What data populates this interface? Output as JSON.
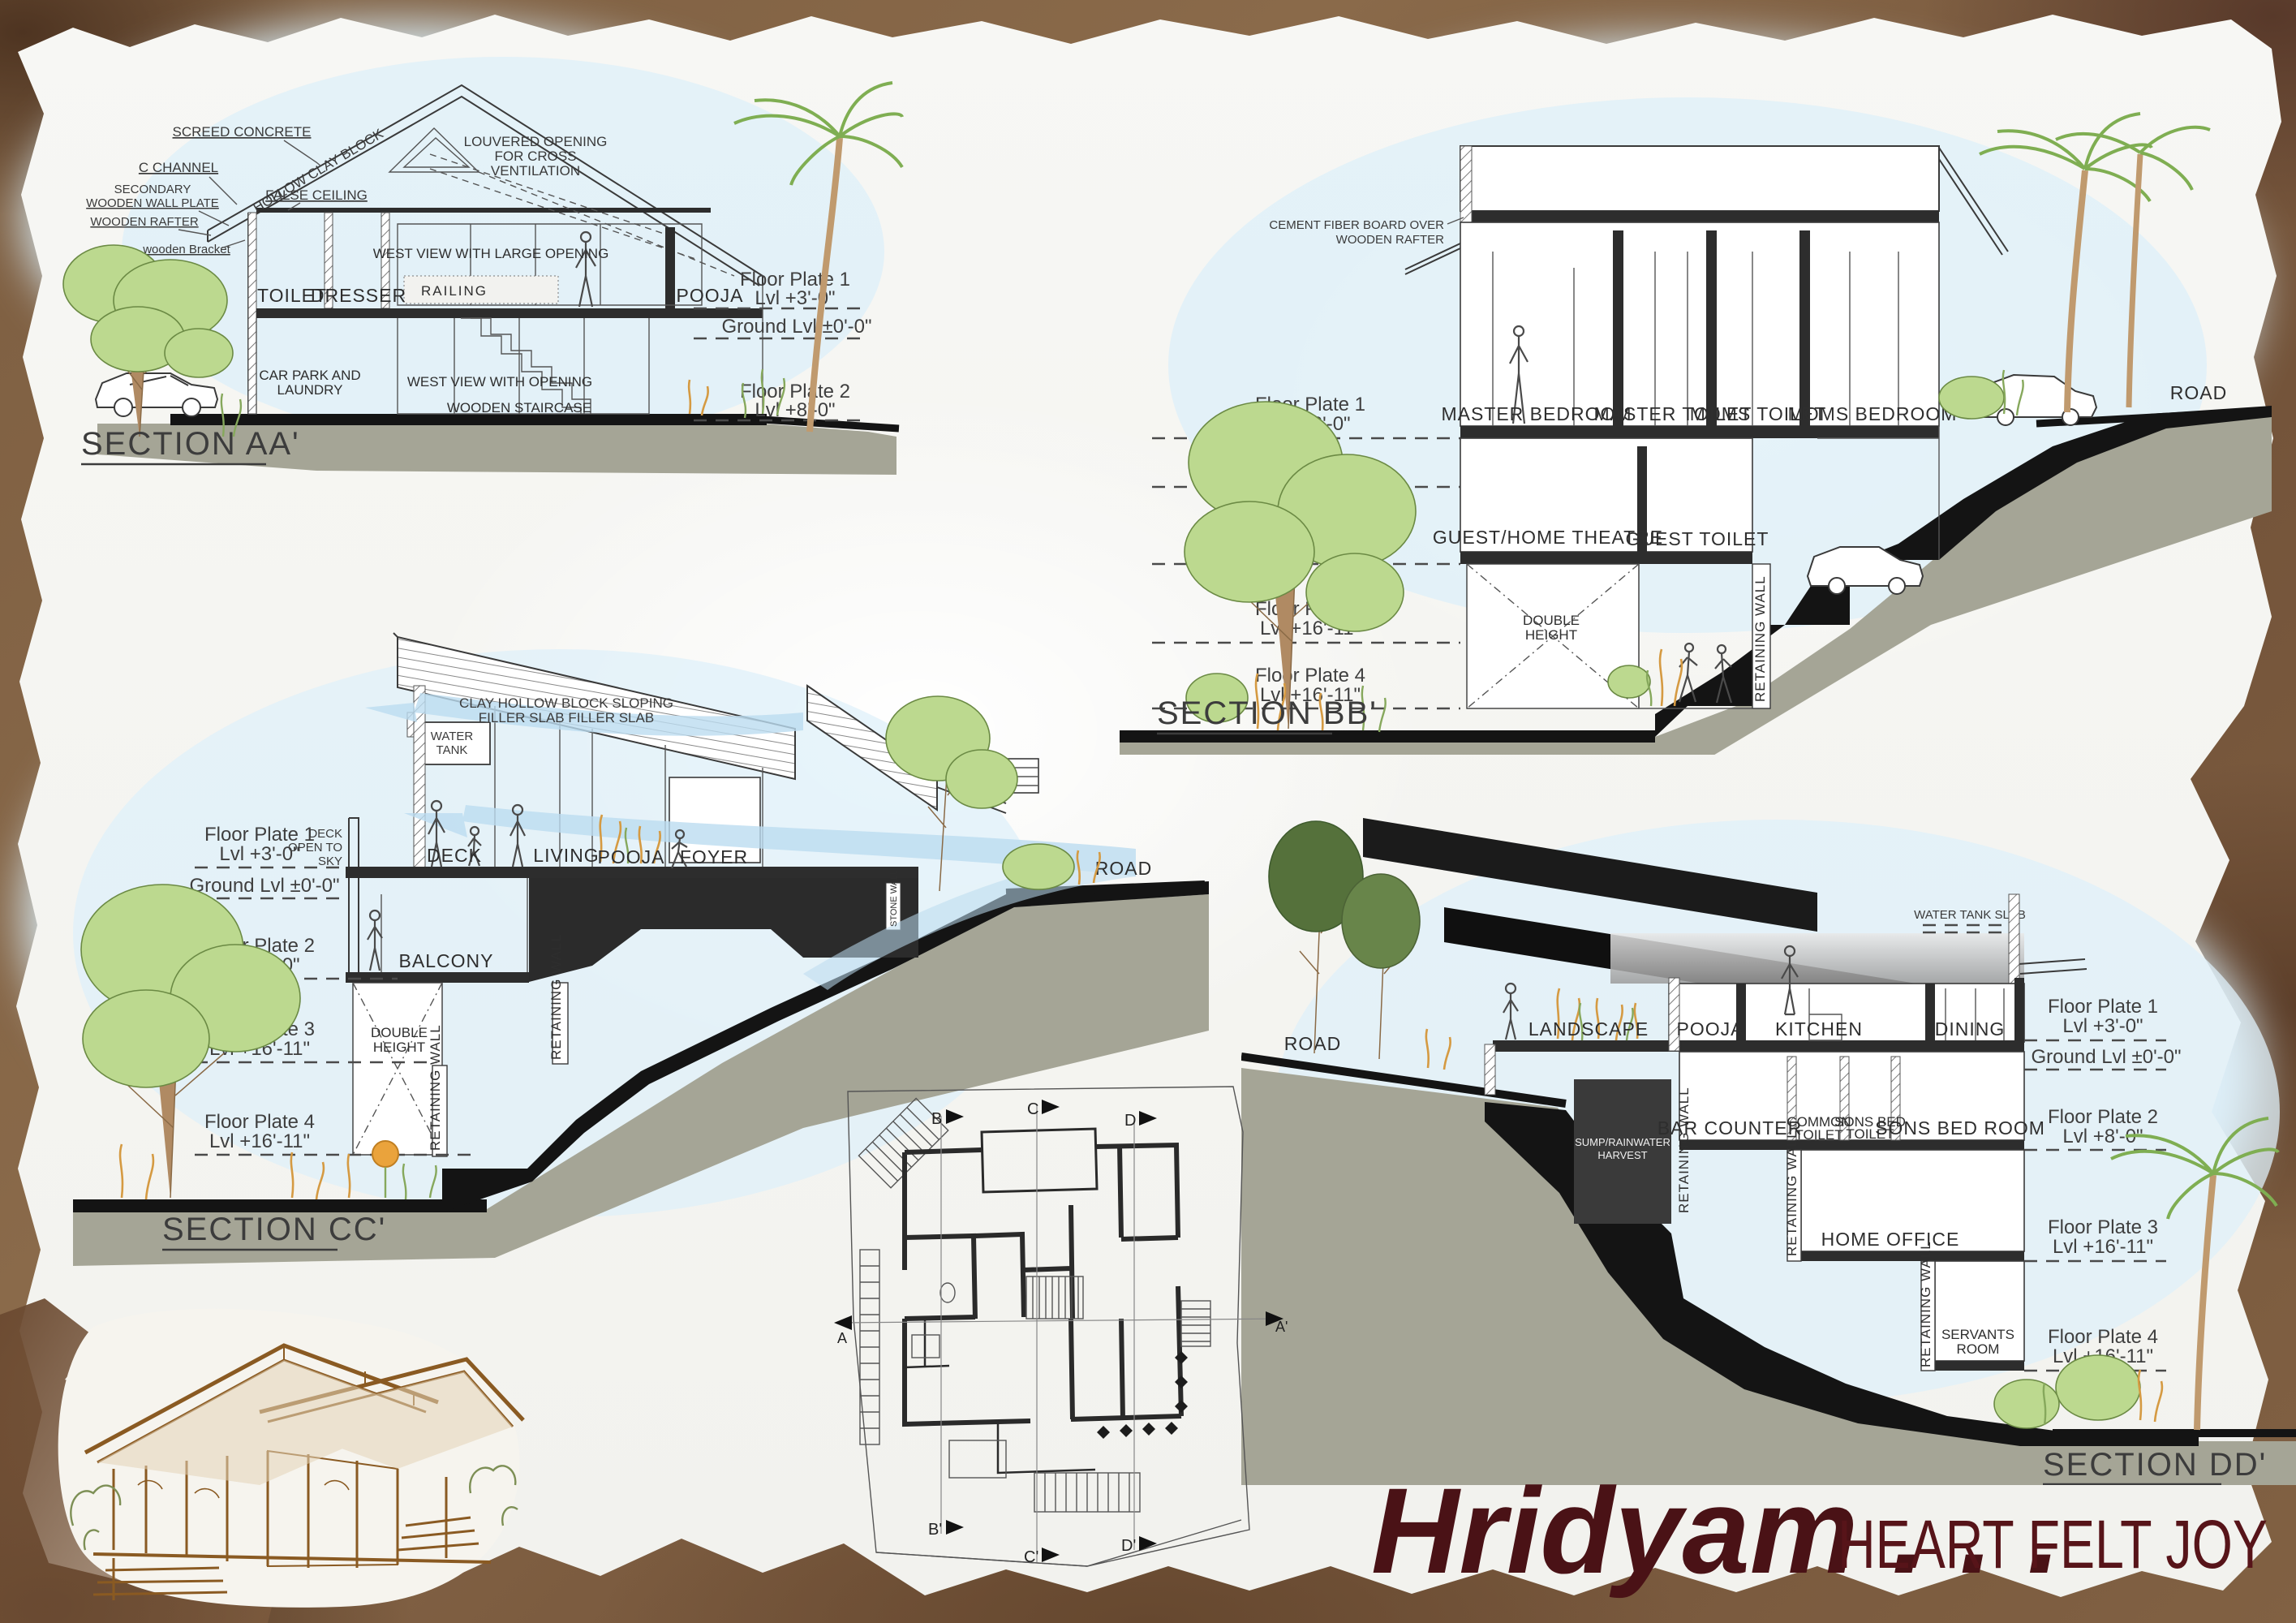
{
  "title": {
    "script": "Hridyam . . .",
    "caps": "HEART FELT JOY"
  },
  "levels": {
    "fp1a": "Floor Plate 1",
    "fp1b": "Lvl +3'-0\"",
    "ground": "Ground Lvl ±0'-0\"",
    "fp2a": "Floor Plate 2",
    "fp2b": "Lvl +8'-0\"",
    "fp3a": "Floor Plate 3",
    "fp3b": "Lvl +16'-11\"",
    "fp4a": "Floor Plate 4",
    "fp4b": "Lvl +16'-11\""
  },
  "shared": {
    "road": "ROAD",
    "retaining_wall": "RETAINING WALL",
    "double_1": "DOUBLE",
    "double_2": "HEIGHT"
  },
  "sections": {
    "aa": {
      "label": "SECTION AA'",
      "screed": "SCREED CONCRETE",
      "c_channel": "C CHANNEL",
      "sec_plate_1": "SECONDARY",
      "sec_plate_2": "WOODEN WALL PLATE",
      "rafter": "WOODEN RAFTER",
      "bracket": "wooden Bracket",
      "hollow": "HOLLOW CLAY BLOCK",
      "false_ceiling": "FALSE CEILING",
      "louver_1": "LOUVERED OPENING",
      "louver_2": "FOR CROSS",
      "louver_3": "VENTILATION",
      "west_large": "WEST VIEW WITH LARGE OPENING",
      "west_open": "WEST VIEW WITH  OPENING",
      "staircase": "WOODEN STAIRCASE",
      "railing": "RAILING",
      "toilet": "TOILET",
      "dresser": "DRESSER",
      "pooja": "POOJA",
      "carpark_1": "CAR PARK AND",
      "carpark_2": "LAUNDRY"
    },
    "bb": {
      "label": "SECTION BB'",
      "fiber_1": "CEMENT FIBER BOARD OVER",
      "fiber_2": "WOODEN RAFTER",
      "master_bedroom": "MASTER BEDROOM",
      "master_toilet": "MASTER TOILET",
      "moms_toilet": "MOMS TOILET",
      "moms_bedroom": "MOMS BEDROOM",
      "guest": "GUEST/HOME THEATRE",
      "guest_toilet": "GUEST TOILET"
    },
    "cc": {
      "label": "SECTION CC'",
      "clay_1": "CLAY HOLLOW BLOCK SLOPING",
      "clay_2": "FILLER SLAB FILLER SLAB",
      "water_1": "WATER",
      "water_2": "TANK",
      "deck_open_1": "DECK",
      "deck_open_2": "OPEN TO",
      "deck_open_3": "SKY",
      "deck": "DECK",
      "living": "LIVING",
      "pooja": "POOJA",
      "foyer": "FOYER",
      "balcony": "BALCONY",
      "stone_wall": "STONE WALL"
    },
    "dd": {
      "label": "SECTION DD'",
      "water_tank_slab": "WATER TANK SLAB",
      "landscape": "LANDSCAPE",
      "pooja": "POOJA",
      "kitchen": "KITCHEN",
      "dining": "DINING",
      "sump_1": "SUMP/RAINWATER",
      "sump_2": "HARVEST",
      "bar": "BAR COUNTER",
      "common_1": "COMMON",
      "common_2": "TOILET",
      "sons_toilet_1": "SONS BED",
      "sons_toilet_2": "TOILET",
      "sons_bedroom": "SONS BED ROOM",
      "home_office": "HOME OFFICE",
      "servants_1": "SERVANTS",
      "servants_2": "ROOM"
    }
  },
  "plan": {
    "markers": {
      "a": "A",
      "a2": "A'",
      "b": "B",
      "b2": "B'",
      "c": "C",
      "c2": "C'",
      "d": "D",
      "d2": "D'"
    }
  },
  "colors": {
    "wash": "#d8ecf6",
    "olive": "#a5a596",
    "maroon": "#4a1216",
    "sepia": "#8a5a22",
    "paper": "#f7f7f4",
    "frame": "#7d5e41"
  }
}
